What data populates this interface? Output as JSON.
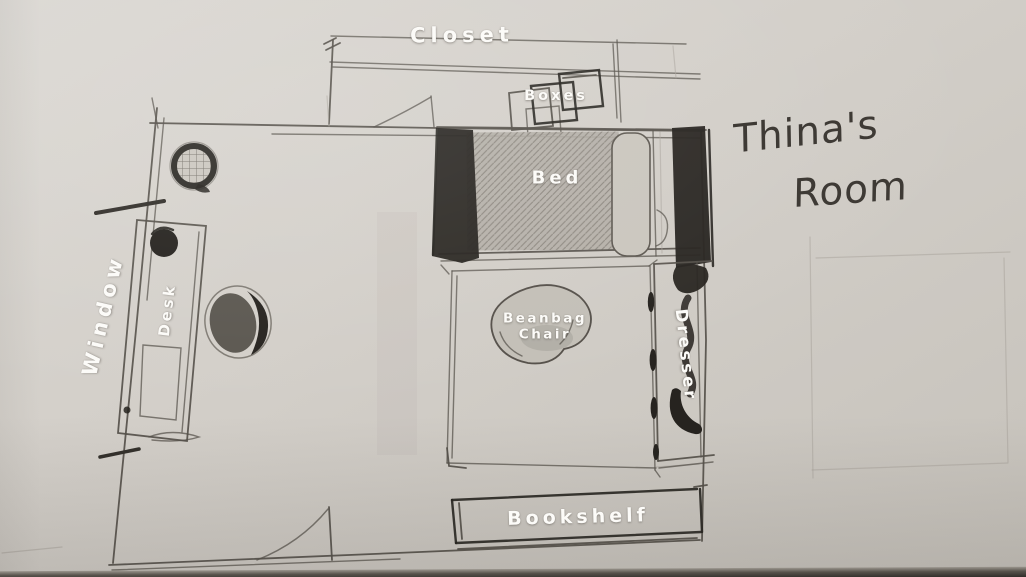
{
  "floor_plan": {
    "title": {
      "full": "Thina's Room",
      "line1": "Thina's",
      "line2": "Room"
    },
    "labels": {
      "closet": "Closet",
      "boxes": "Boxes",
      "bed": "Bed",
      "window": "Window",
      "desk": "Desk",
      "beanbag_line1": "Beanbag",
      "beanbag_line2": "Chair",
      "dresser": "Dresser",
      "bookshelf": "Bookshelf"
    },
    "colors": {
      "paper_light": "#dbd8d3",
      "paper_dark": "#c6c2bb",
      "pencil": "#55504a",
      "pencil_dark": "#26231f",
      "label_text": "#fcfbf8",
      "handwriting": "#3e3a35"
    }
  }
}
